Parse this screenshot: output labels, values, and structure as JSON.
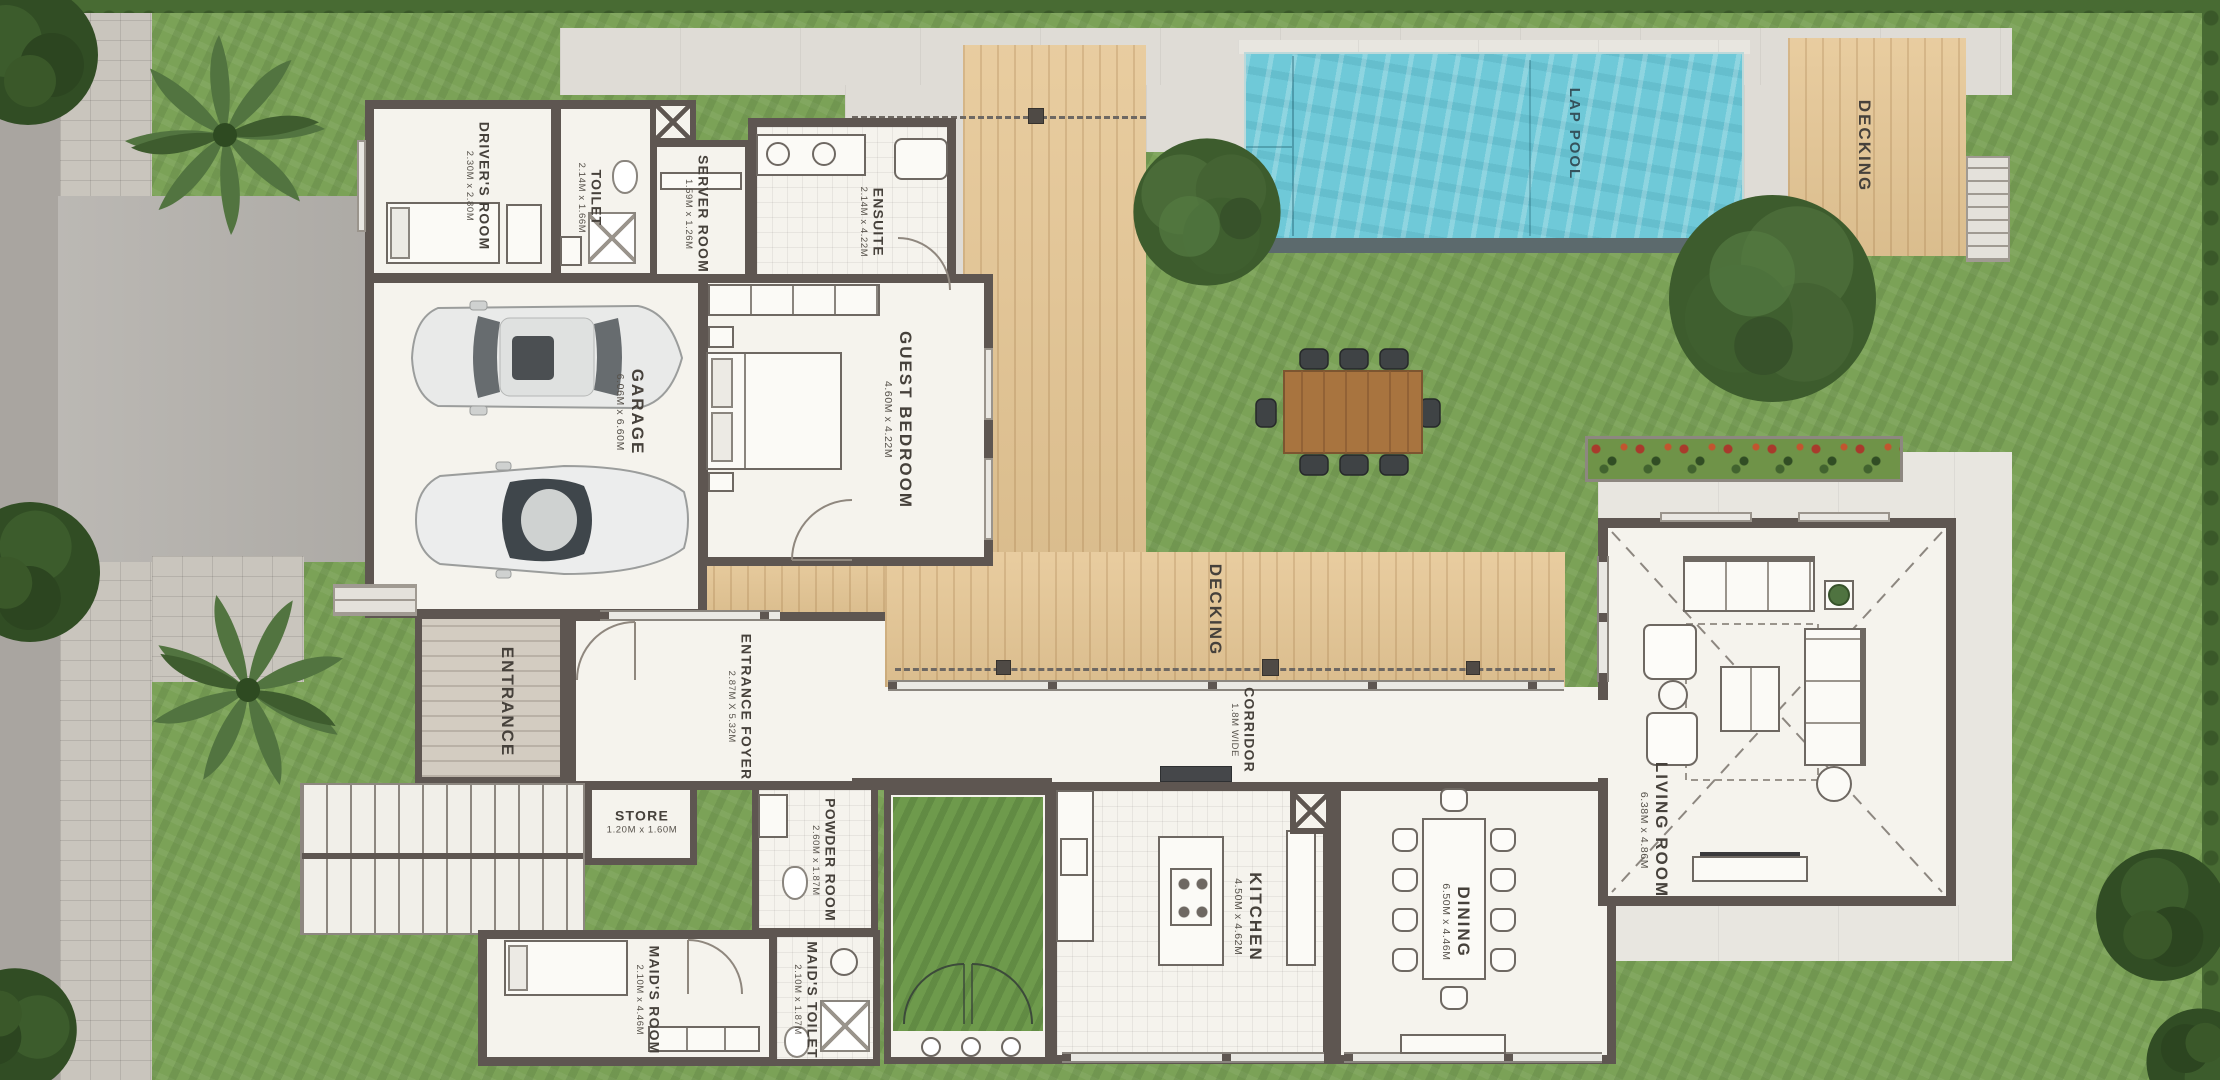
{
  "site": {
    "labels": {
      "drivers_room": {
        "name": "DRIVER'S ROOM",
        "dims": "2.30M x 2.80M"
      },
      "toilet": {
        "name": "TOILET",
        "dims": "2.14M x 1.66M"
      },
      "server_room": {
        "name": "SERVER ROOM",
        "dims": "1.59M x 1.26M"
      },
      "ensuite": {
        "name": "ENSUITE",
        "dims": "2.14M x 4.22M"
      },
      "guest_bedroom": {
        "name": "GUEST BEDROOM",
        "dims": "4.60M x 4.22M"
      },
      "garage": {
        "name": "GARAGE",
        "dims": "6.06M x 6.60M"
      },
      "entrance": {
        "name": "ENTRANCE"
      },
      "entrance_foyer": {
        "name": "ENTRANCE FOYER",
        "dims": "2.87M X 5.32M"
      },
      "store": {
        "name": "STORE",
        "dims": "1.20M x 1.60M"
      },
      "powder_room": {
        "name": "POWDER ROOM",
        "dims": "2.60M x 1.87M"
      },
      "maids_room": {
        "name": "MAID'S ROOM",
        "dims": "2.10M x 4.46M"
      },
      "maids_toilet": {
        "name": "MAID'S TOILET",
        "dims": "2.10M x 1.87M"
      },
      "kitchen": {
        "name": "KITCHEN",
        "dims": "4.50M x 4.62M"
      },
      "dining": {
        "name": "DINING",
        "dims": "6.50M x 4.46M"
      },
      "corridor": {
        "name": "CORRIDOR",
        "dims": "1.8M WIDE"
      },
      "living_room": {
        "name": "LIVING ROOM",
        "dims": "6.38M x 4.86M"
      },
      "lap_pool": {
        "name": "LAP POOL"
      },
      "decking_center": {
        "name": "DECKING"
      },
      "decking_pool": {
        "name": "DECKING"
      }
    },
    "colors": {
      "grass": "#7ba257",
      "grass_dark": "#486b33",
      "deck_wood": "#e6c795",
      "pool_water": "#6fc9d8",
      "wall": "#5e5651",
      "floor": "#f5f3ed",
      "concrete": "#dfdcd6",
      "driveway": "#b6b3ae",
      "tree_canopy": "#3d5c2d"
    }
  }
}
